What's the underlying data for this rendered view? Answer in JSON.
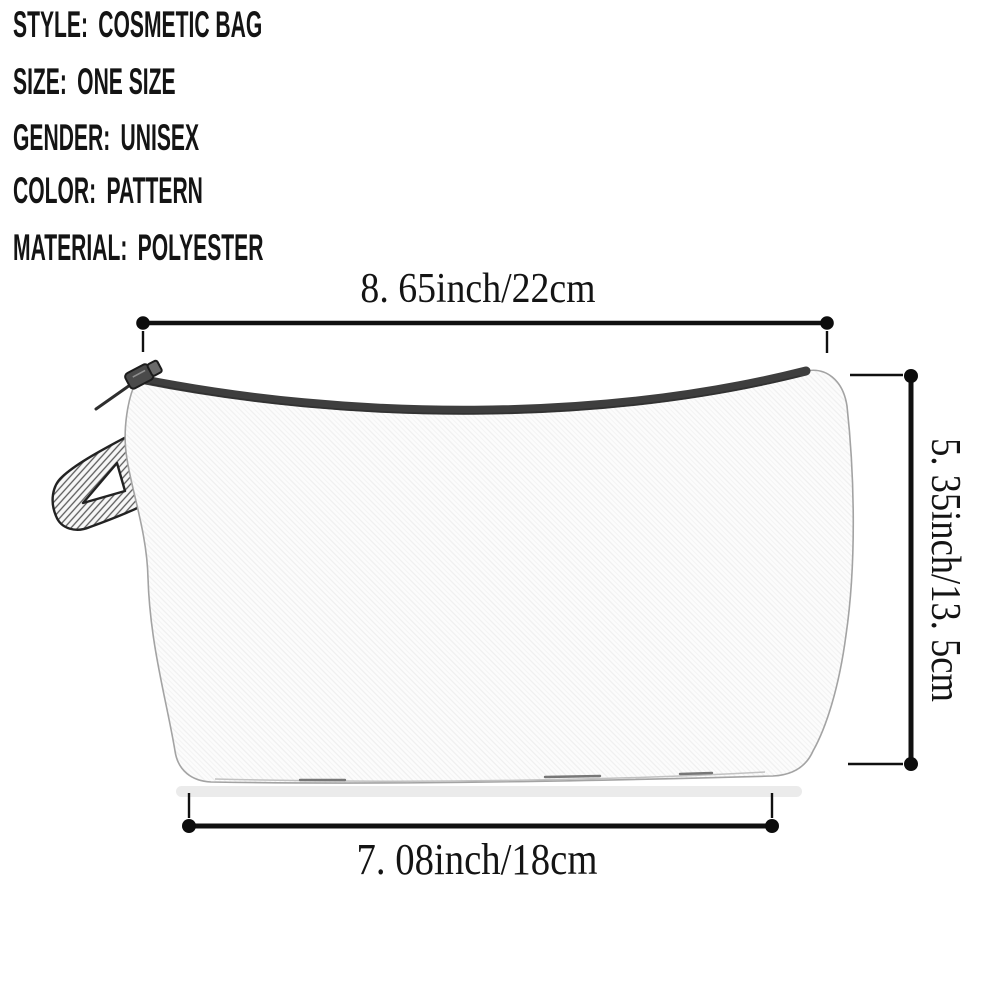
{
  "spec_list": {
    "rows": [
      {
        "label": "STYLE:",
        "value": "COSMETIC BAG"
      },
      {
        "label": "SIZE:",
        "value": "ONE SIZE"
      },
      {
        "label": "GENDER:",
        "value": "UNISEX"
      },
      {
        "label": "COLOR:",
        "value": "PATTERN"
      },
      {
        "label": "MATERIAL:",
        "value": "POLYESTER"
      }
    ]
  },
  "dimensions": {
    "top_width": "8. 65inch/22cm",
    "side_height": "5. 35inch/13. 5cm",
    "bottom_width": "7. 08inch/18cm"
  },
  "illustration": {
    "item": "cosmetic-bag-sketch",
    "features": [
      "zipper",
      "zipper-pull-cord",
      "hang-loop"
    ]
  },
  "colors": {
    "ink": "#141414",
    "dimension_line": "#101010",
    "zipper": "#3e3e3e",
    "bag_fill": "#fcfcfc",
    "bag_outline": "#a3a3a3",
    "shadow": "#e8e8e8",
    "background": "#ffffff"
  }
}
